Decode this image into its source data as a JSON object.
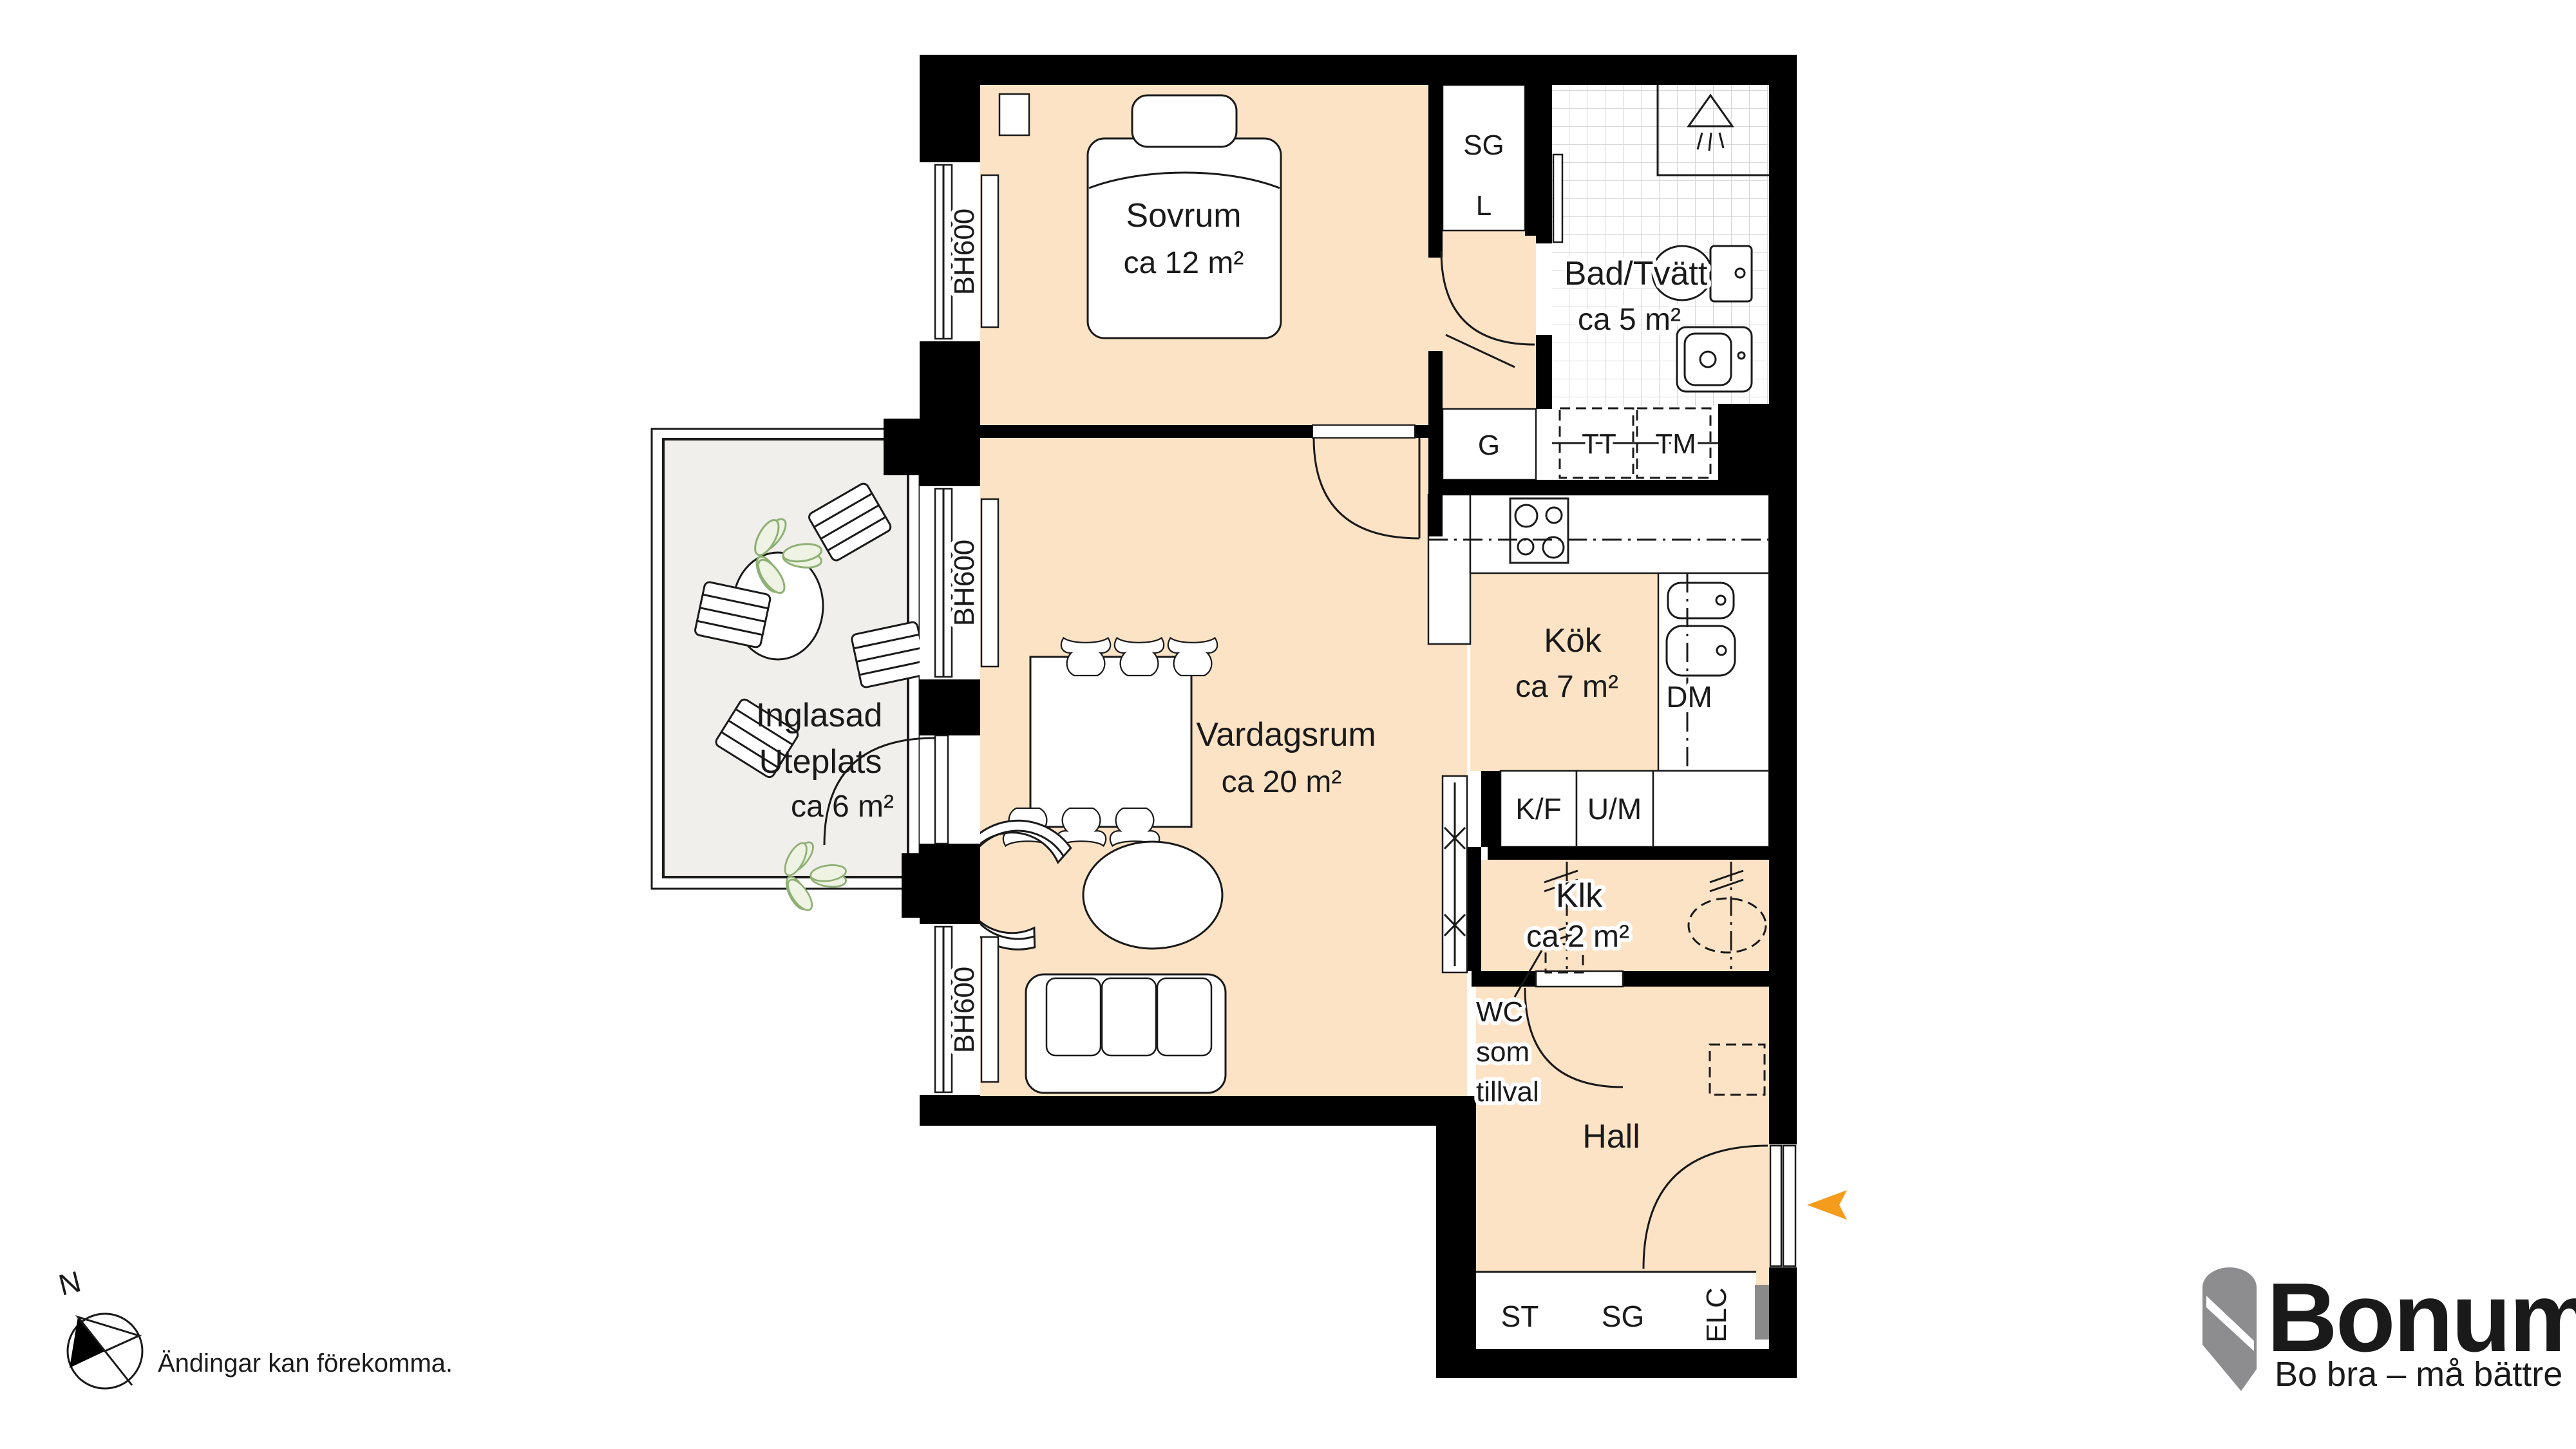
{
  "rooms": {
    "sovrum": {
      "name": "Sovrum",
      "area": "ca 12 m²"
    },
    "bad": {
      "name": "Bad/Tvätt",
      "area": "ca 5 m²"
    },
    "kok": {
      "name": "Kök",
      "area": "ca 7 m²"
    },
    "vardagsrum": {
      "name": "Vardagsrum",
      "area": "ca 20 m²"
    },
    "uteplats": {
      "line1": "Inglasad",
      "line2": "Uteplats",
      "area": "ca 6 m²"
    },
    "klk": {
      "name": "Klk",
      "area": "ca 2 m²"
    },
    "hall": {
      "name": "Hall"
    }
  },
  "fixtures": {
    "sg_closet": "SG",
    "l_closet": "L",
    "g_closet": "G",
    "tt": "TT",
    "tm": "TM",
    "dm": "DM",
    "kf": "K/F",
    "um": "U/M",
    "st": "ST",
    "sg_hall": "SG",
    "elc": "ELC"
  },
  "windows": {
    "label": "BH600"
  },
  "annotations": {
    "wc_line1": "WC",
    "wc_line2": "som",
    "wc_line3": "tillval",
    "compass_n": "N",
    "disclaimer": "Ändingar kan förekomma."
  },
  "logo": {
    "name": "Bonum",
    "tagline": "Bo bra – må bättre"
  },
  "colors": {
    "floor": "#fce3c6",
    "patio_floor": "#f0efec",
    "wall": "#000000",
    "accent_orange": "#f59c1c",
    "logo_gray": "#8d8d90",
    "tile_line": "#d8d8d8",
    "elc_gray": "#8a8a8a"
  }
}
